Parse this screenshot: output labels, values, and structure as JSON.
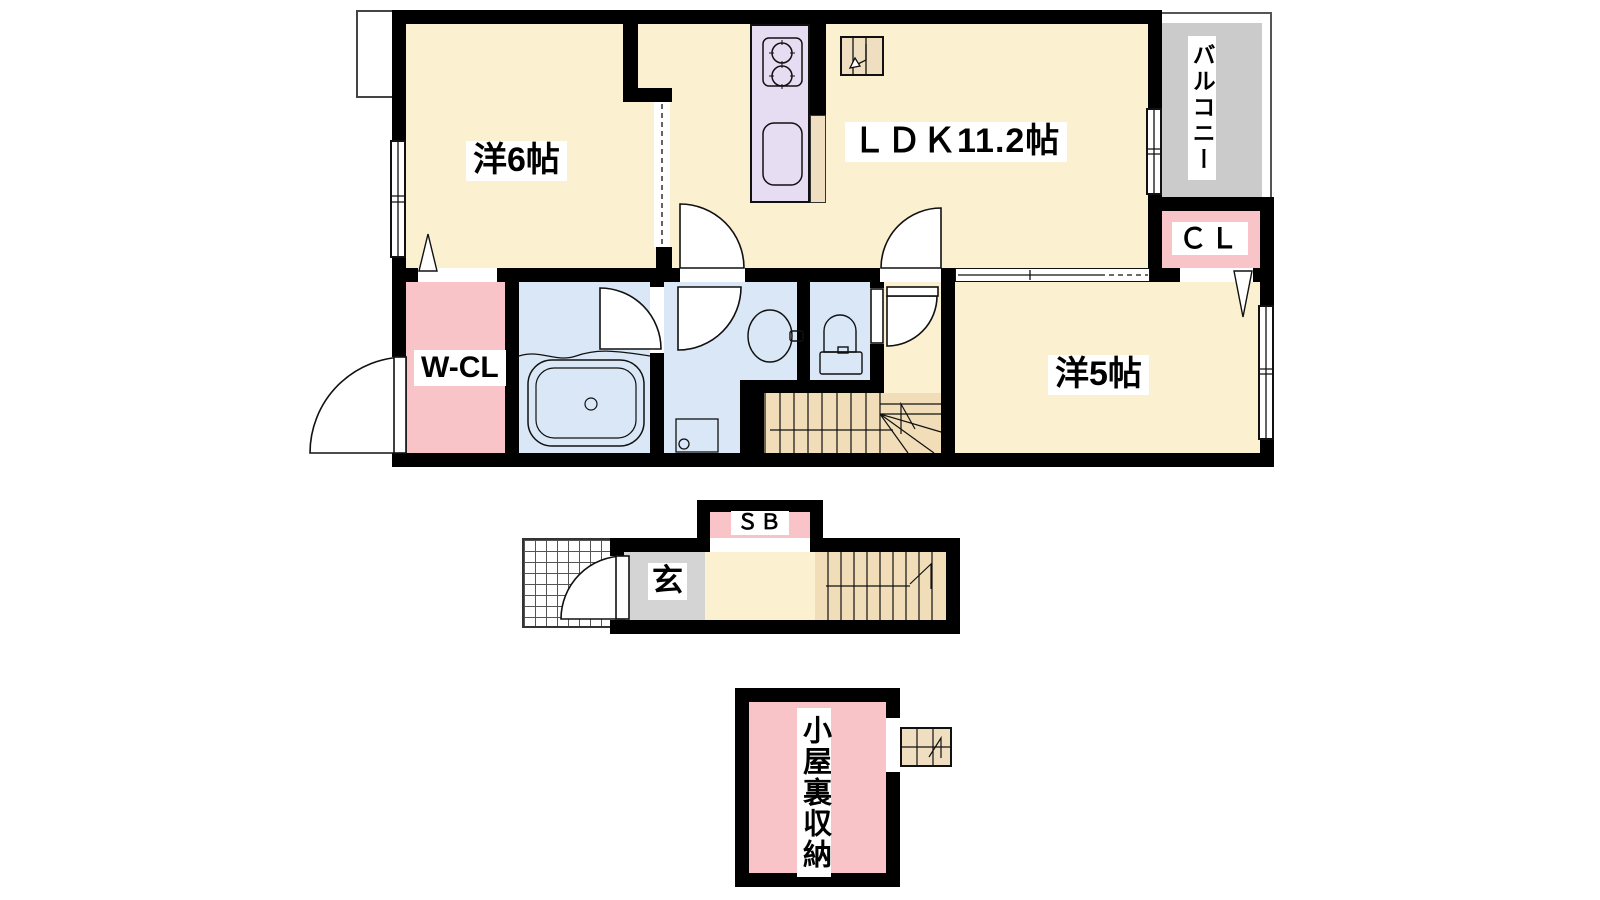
{
  "rooms": {
    "western6": {
      "label": "洋6帖"
    },
    "ldk": {
      "label": "ＬＤＫ11.2帖"
    },
    "balcony": {
      "label": "バルコニー"
    },
    "closet": {
      "label": "ＣＬ"
    },
    "walk_in_closet": {
      "label": "W-CL"
    },
    "western5": {
      "label": "洋5帖"
    },
    "entrance": {
      "label": "玄"
    },
    "shoe_box": {
      "label": "ＳＢ"
    },
    "attic_storage": {
      "label": "小屋裏収納"
    }
  },
  "colors": {
    "room_cream": "#FBF0D0",
    "closet_pink": "#F9C4C8",
    "kitchen_lavender": "#E6DDF2",
    "wet_area_blue": "#D9E7F6",
    "balcony_gray": "#CBCBCB",
    "entrance_gray": "#D4D4D4",
    "stairs_tan": "#F1DEB9",
    "wall_black": "#000000"
  }
}
